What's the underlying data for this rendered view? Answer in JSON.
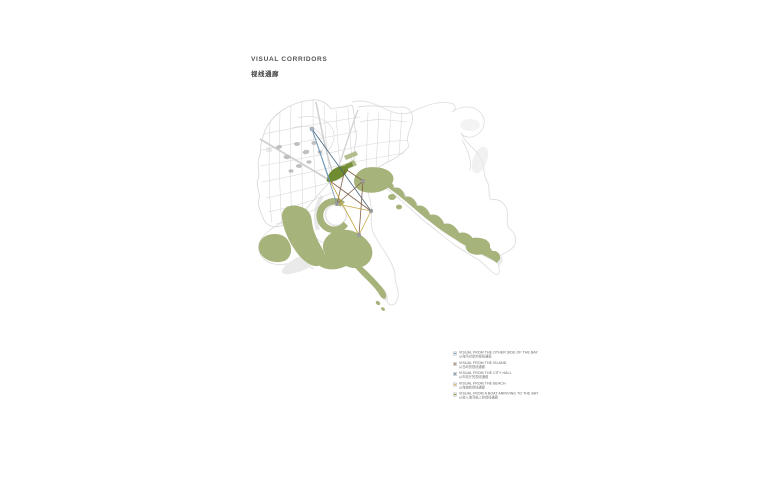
{
  "title": {
    "en": "VISUAL CORRIDORS",
    "zh": "视线通廊"
  },
  "legend": {
    "items": [
      {
        "label_en": "VISUAL FROM THE OTHER SIDE OF THE BAY",
        "label_zh": "从海湾对岸的视线通廊",
        "color": "#6d94b8"
      },
      {
        "label_en": "VISUAL FROM THE ISLAND",
        "label_zh": "从岛屿的视线通廊",
        "color": "#7c5a40"
      },
      {
        "label_en": "VISUAL FROM THE CITY HALL",
        "label_zh": "从市政厅的视线通廊",
        "color": "#3f6077"
      },
      {
        "label_en": "VISUAL FROM THE BEACH",
        "label_zh": "从海滩的视线通廊",
        "color": "#c2a23c"
      },
      {
        "label_en": "VISUAL FROM A BOAT ARRIVING TO THE BAY",
        "label_zh": "从驶入海湾船上的视线通廊",
        "color": "#6f8c31"
      }
    ]
  },
  "colors": {
    "sage_green": "#a6b37b",
    "dark_olive": "#6f8c31",
    "shadow_gray": "#eaeaea",
    "coast_gray": "#dcdcdc",
    "street_gray": "#d5d5d5",
    "building_gray": "#c0c0c0",
    "road_gray": "#cfcfcf",
    "corridor_blue": "#6d94b8",
    "corridor_teal": "#3f6077",
    "corridor_brown": "#7c5a40",
    "corridor_yellow": "#c2a23c",
    "marker_gray": "#6b6b6b"
  }
}
